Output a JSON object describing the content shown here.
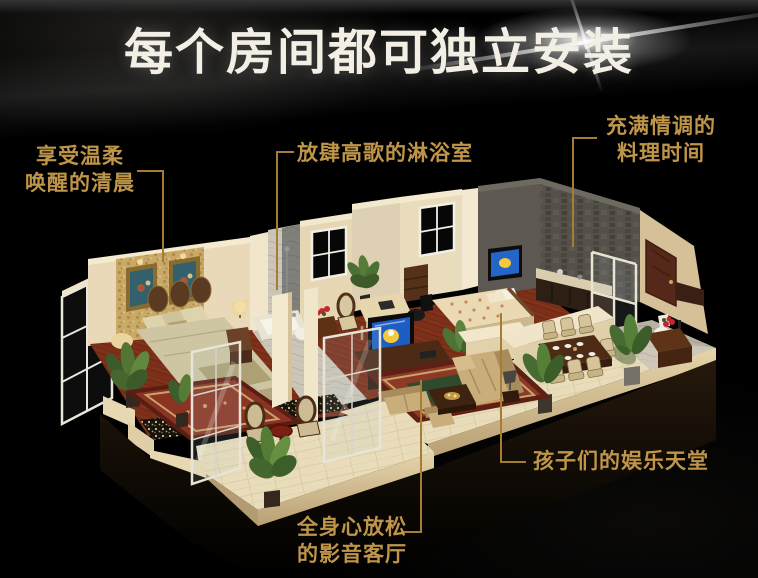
{
  "title": "每个房间都可独立安装",
  "annotations": {
    "bedroom": {
      "lines": [
        "享受温柔",
        "唤醒的清晨"
      ]
    },
    "shower": {
      "lines": [
        "放肆高歌的淋浴室"
      ]
    },
    "kitchen": {
      "lines": [
        "充满情调的",
        "料理时间"
      ]
    },
    "kids": {
      "lines": [
        "孩子们的娱乐天堂"
      ]
    },
    "living": {
      "lines": [
        "全身心放松",
        "的影音客厅"
      ]
    }
  },
  "palette": {
    "background": "#000000",
    "title_white": "#f3efe4",
    "label_gold": "#bf9549",
    "leader_line_gold": "#a57d35",
    "wall_cream": "#e9d9b8",
    "wallpaper_gold": "#c9a968",
    "floor_wood_red": "#7c2f19",
    "rug_red": "#8c3a26",
    "rug_center_green": "#2f4a2c",
    "stone_wall_gray": "#54504a",
    "sofa_tan": "#c9ae7c",
    "wood_dark": "#4c2a15",
    "tv_screen_blue": "#2060c4",
    "cartoon_yellow": "#f6c83c",
    "plant_green": "#4c7032",
    "marble": "#ccc6b8"
  },
  "scene": {
    "regions": [
      "bedroom",
      "bathroom",
      "study",
      "media-wall",
      "kids-room",
      "kitchen",
      "dining-room",
      "powder-corner",
      "living-room",
      "balcony"
    ]
  }
}
